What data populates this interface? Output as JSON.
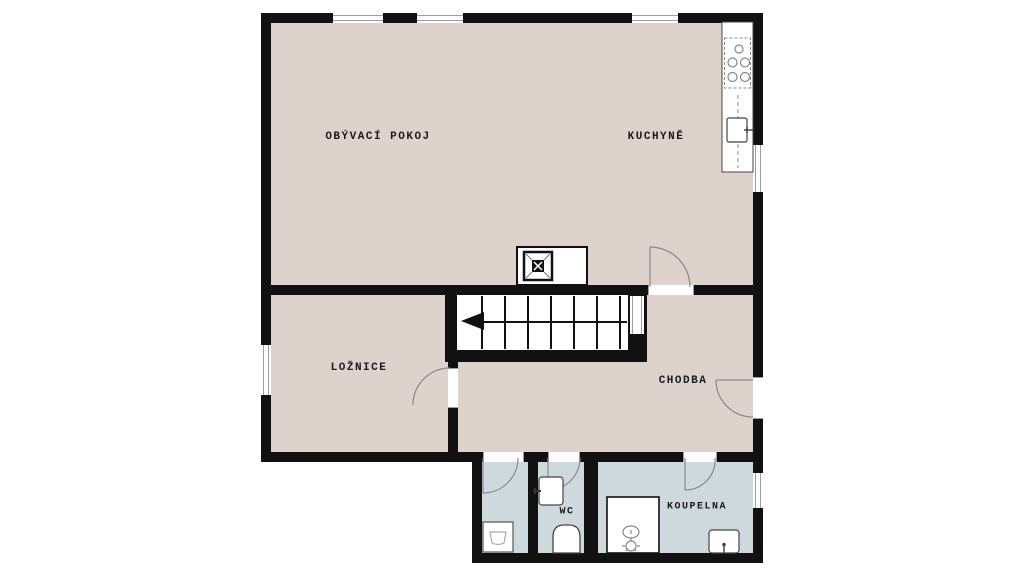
{
  "plan": {
    "title": "Floor plan",
    "rooms": [
      {
        "id": "obyvaci-pokoj",
        "label": "OBÝVACÍ POKOJ"
      },
      {
        "id": "kuchyne",
        "label": "KUCHYNĚ"
      },
      {
        "id": "loznice",
        "label": "LOŽNICE"
      },
      {
        "id": "chodba",
        "label": "CHODBA"
      },
      {
        "id": "wc",
        "label": "WC"
      },
      {
        "id": "koupelna",
        "label": "KOUPELNA"
      }
    ],
    "fixtures": [
      "kitchen-counter",
      "cooktop",
      "kitchen-sink",
      "chimney-stove",
      "staircase",
      "washing-machine",
      "wc-hand-basin",
      "toilet",
      "shower",
      "bathroom-sink"
    ],
    "colors": {
      "floor": "#ddd2cc",
      "wet_floor": "#cdd9dd",
      "wall": "#111111",
      "window_line": "#9aa0a0",
      "background": "#ffffff",
      "fixture_line": "#555555"
    }
  }
}
